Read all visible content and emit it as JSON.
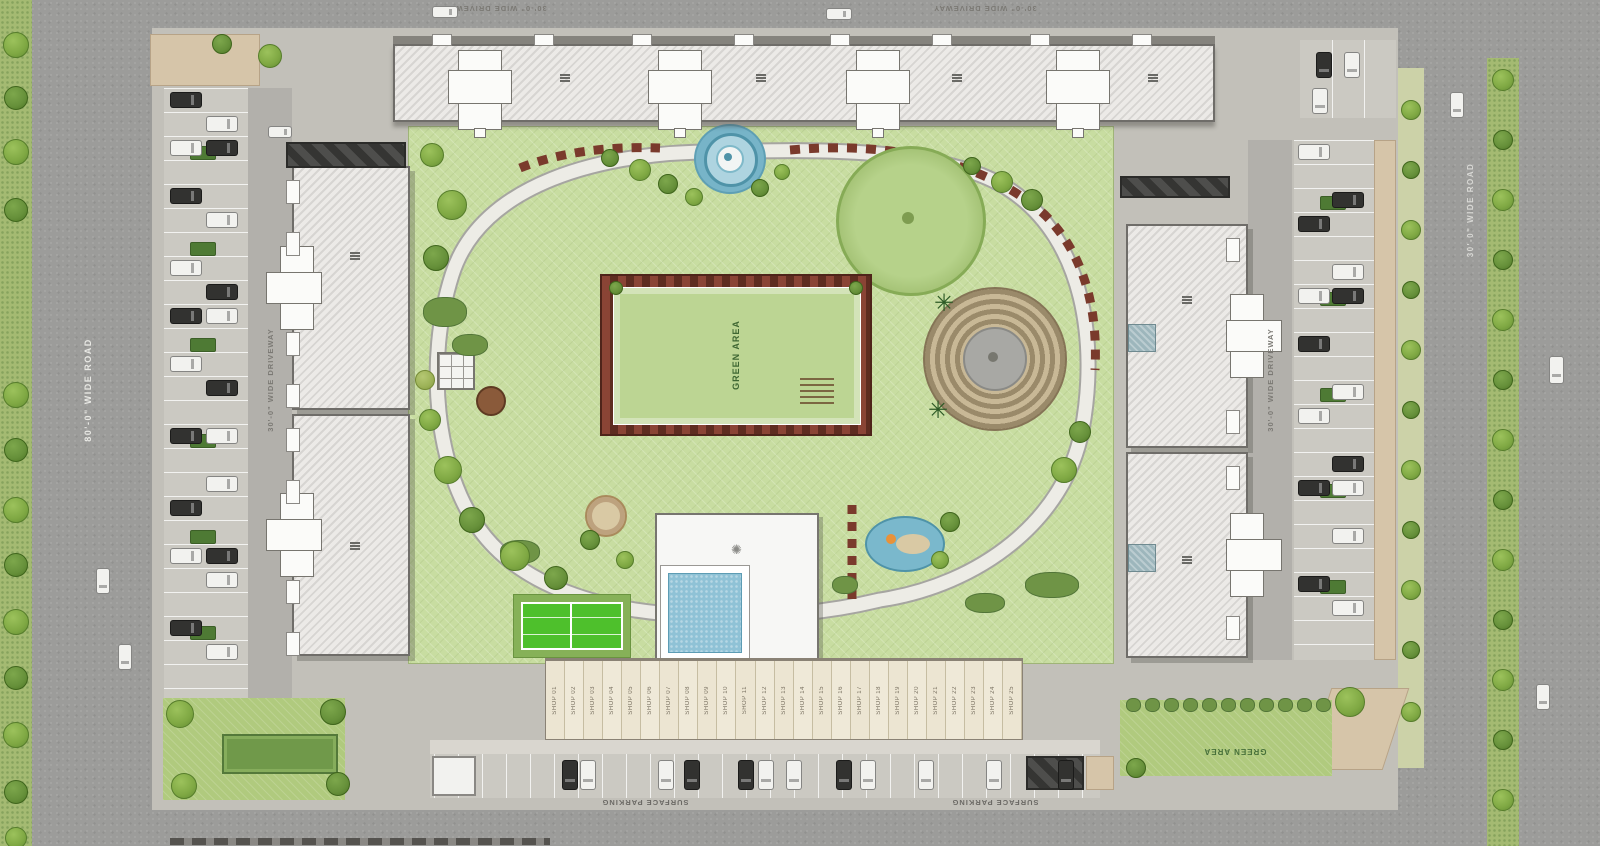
{
  "labels": {
    "road_80": "80'-0\" WIDE ROAD",
    "road_30": "30'-0\" WIDE ROAD",
    "driveway_30": "30'-0\" WIDE DRIVEWAY",
    "green_area": "GREEN AREA",
    "surface_parking": "SURFACE PARKING"
  },
  "shops": [
    "SHOP 01",
    "SHOP 02",
    "SHOP 03",
    "SHOP 04",
    "SHOP 05",
    "SHOP 06",
    "SHOP 07",
    "SHOP 08",
    "SHOP 09",
    "SHOP 10",
    "SHOP 11",
    "SHOP 12",
    "SHOP 13",
    "SHOP 14",
    "SHOP 15",
    "SHOP 16",
    "SHOP 17",
    "SHOP 18",
    "SHOP 19",
    "SHOP 20",
    "SHOP 21",
    "SHOP 22",
    "SHOP 23",
    "SHOP 24",
    "SHOP 25"
  ],
  "colors": {
    "road": "#9c9c9a",
    "park_green": "#c8dda1",
    "lawn_green": "#b0ca7e",
    "building": "#eceae7",
    "pool_water": "#8fc2d6",
    "flower_bed": "#7a3a2c",
    "tennis_court": "#4ec02c",
    "shop_cream": "#efe9d8"
  }
}
